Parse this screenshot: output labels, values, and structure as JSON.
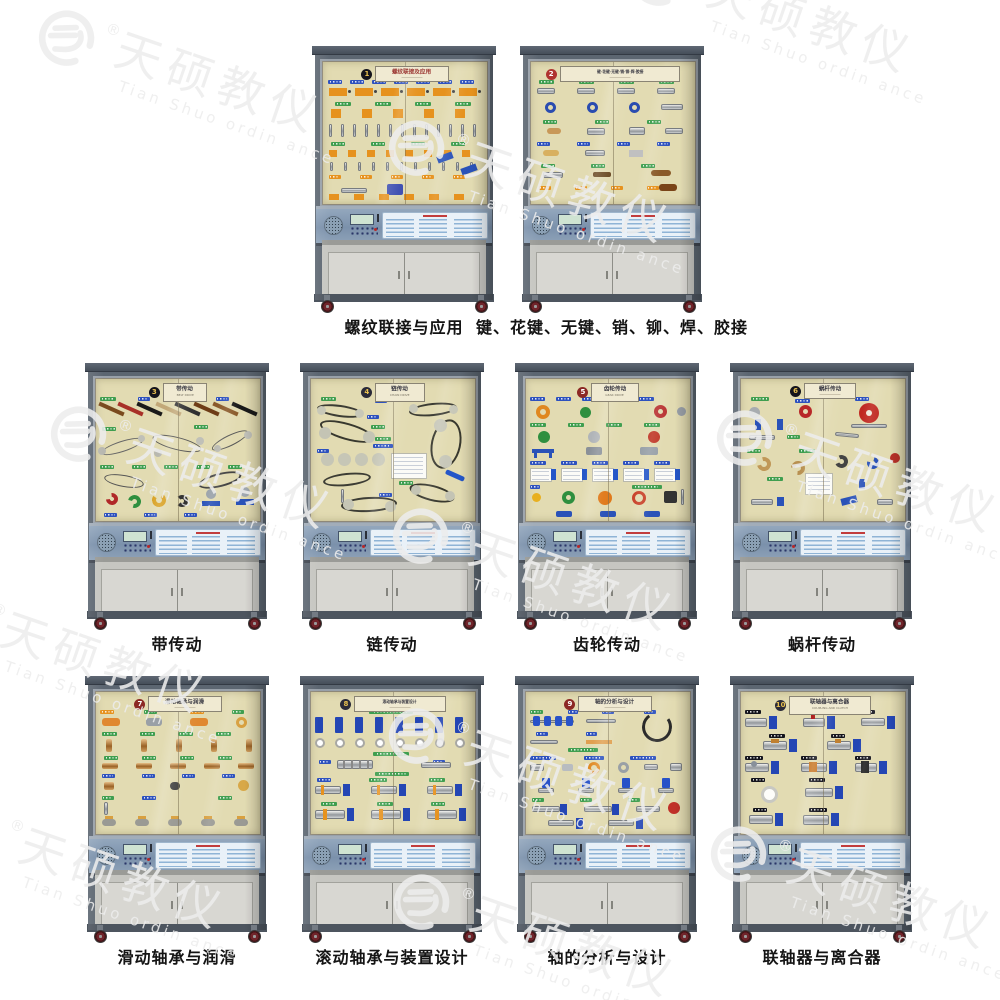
{
  "watermark": {
    "brand_cn": "天硕教仪",
    "brand_en": "Tian Shuo ordin ance",
    "registered": "®"
  },
  "colors": {
    "frame": "#5c6671",
    "window": "#e2dbb2",
    "base": "#c6c6c1",
    "door": "#d8d7d2",
    "wheel": "#70242a",
    "caption": "#141414"
  },
  "cabinets": [
    {
      "badge": "1",
      "badge_color": "#14141c",
      "badge_text_color": "#e8c050",
      "plaque": "螺纹联接及应用",
      "plaque_en": "",
      "plaque_color": "#9a3430",
      "caption": "螺纹联接与应用",
      "theme": "threads"
    },
    {
      "badge": "2",
      "badge_color": "#b03430",
      "badge_text_color": "#ffffff",
      "plaque": "键·花键·无键·销·铆·焊·胶接",
      "plaque_en": "",
      "plaque_color": "#3a3a44",
      "caption": "键、花键、无键、销、铆、焊、胶接",
      "theme": "keys"
    },
    {
      "badge": "3",
      "badge_color": "#14141c",
      "badge_text_color": "#e8c050",
      "plaque": "带传动",
      "plaque_en": "BELT DRIVE",
      "plaque_color": "#3a3a44",
      "caption": "带传动",
      "theme": "belts"
    },
    {
      "badge": "4",
      "badge_color": "#2a2a38",
      "badge_text_color": "#e8c050",
      "plaque": "链传动",
      "plaque_en": "CHAIN DRIVE",
      "plaque_color": "#3a3a44",
      "caption": "链传动",
      "theme": "chains"
    },
    {
      "badge": "5",
      "badge_color": "#8c2824",
      "badge_text_color": "#ffffff",
      "plaque": "齿轮传动",
      "plaque_en": "GEAR DRIVE",
      "plaque_color": "#3a3a44",
      "caption": "齿轮传动",
      "theme": "gears"
    },
    {
      "badge": "6",
      "badge_color": "#14141c",
      "badge_text_color": "#e8c050",
      "plaque": "蜗杆传动",
      "plaque_en": "",
      "plaque_color": "#3a3a44",
      "caption": "蜗杆传动",
      "theme": "worm"
    },
    {
      "badge": "7",
      "badge_color": "#8c2824",
      "badge_text_color": "#ffffff",
      "plaque": "滑动轴承与润滑",
      "plaque_en": "",
      "plaque_color": "#3a3a44",
      "caption": "滑动轴承与润滑",
      "theme": "sliding"
    },
    {
      "badge": "8",
      "badge_color": "#2a2a38",
      "badge_text_color": "#e8c050",
      "plaque": "滚动轴承与装置设计",
      "plaque_en": "",
      "plaque_color": "#3a3a44",
      "caption": "滚动轴承与装置设计",
      "theme": "rolling"
    },
    {
      "badge": "9",
      "badge_color": "#8c2824",
      "badge_text_color": "#ffffff",
      "plaque": "轴的分析与设计",
      "plaque_en": "",
      "plaque_color": "#3a3a44",
      "caption": "轴的分析与设计",
      "theme": "shafts"
    },
    {
      "badge": "10",
      "badge_color": "#2a2a38",
      "badge_text_color": "#e8c050",
      "plaque": "联轴器与离合器",
      "plaque_en": "COUPLING AND CLUTCH",
      "plaque_color": "#3a3a44",
      "caption": "联轴器与离合器",
      "theme": "couplings"
    }
  ]
}
